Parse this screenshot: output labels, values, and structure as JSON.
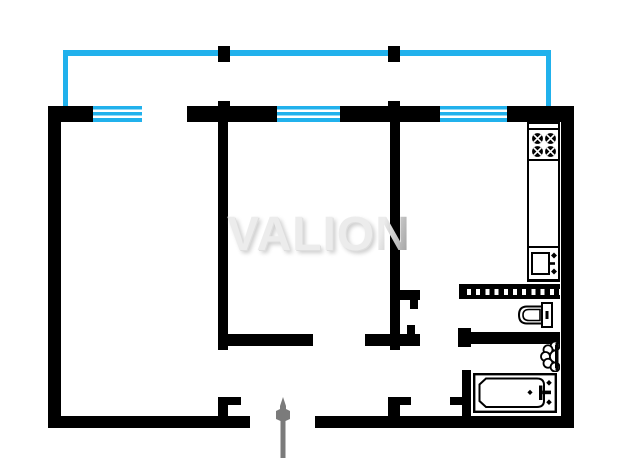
{
  "watermark": {
    "main": "VALIO",
    "last": "N",
    "full_text": "VALION"
  },
  "colors": {
    "wall": "#000000",
    "balcony": "#21b1ec",
    "window_cyan": "#21b1ec",
    "arrow_gray": "#7b7b7b",
    "background": "#ffffff",
    "watermark_light": "#ececec",
    "watermark_dark": "#a0a0a0"
  },
  "plan": {
    "canvas": {
      "width": 630,
      "height": 475
    },
    "door_openings": [
      "balcony-door-opening",
      "bedroom-door-opening",
      "livingroom-door-opening",
      "kitchen-door-opening",
      "wc-door-opening",
      "bathroom-door-opening",
      "entrance-door-opening"
    ],
    "elements": [
      {
        "name": "balcony-rail-top",
        "cls": "balcony",
        "x": 63,
        "y": 50,
        "w": 488,
        "h": 6
      },
      {
        "name": "balcony-rail-left",
        "cls": "balcony",
        "x": 63,
        "y": 50,
        "w": 5,
        "h": 57
      },
      {
        "name": "balcony-rail-right",
        "cls": "balcony",
        "x": 546,
        "y": 50,
        "w": 5,
        "h": 57
      },
      {
        "name": "balcony-divider-left",
        "cls": "wall",
        "x": 218,
        "y": 46,
        "w": 12,
        "h": 16
      },
      {
        "name": "balcony-divider-right",
        "cls": "wall",
        "x": 388,
        "y": 46,
        "w": 12,
        "h": 16
      },
      {
        "name": "top-wall-a",
        "cls": "wall",
        "x": 48,
        "y": 106,
        "w": 45,
        "h": 16
      },
      {
        "name": "top-wall-b",
        "cls": "wall",
        "x": 187,
        "y": 106,
        "w": 90,
        "h": 16
      },
      {
        "name": "top-wall-c",
        "cls": "wall",
        "x": 340,
        "y": 106,
        "w": 100,
        "h": 16
      },
      {
        "name": "top-wall-d",
        "cls": "wall",
        "x": 507,
        "y": 106,
        "w": 67,
        "h": 16
      },
      {
        "name": "top-wall-bump-left",
        "cls": "wall",
        "x": 218,
        "y": 101,
        "w": 12,
        "h": 6
      },
      {
        "name": "top-wall-bump-right",
        "cls": "wall",
        "x": 388,
        "y": 101,
        "w": 12,
        "h": 6
      },
      {
        "name": "window-livingroom",
        "cls": "window",
        "x": 93,
        "y": 106,
        "w": 49,
        "h": 16
      },
      {
        "name": "window-bedroom",
        "cls": "window",
        "x": 277,
        "y": 106,
        "w": 63,
        "h": 16
      },
      {
        "name": "window-kitchen",
        "cls": "window",
        "x": 440,
        "y": 106,
        "w": 67,
        "h": 16
      },
      {
        "name": "left-wall",
        "cls": "wall",
        "x": 48,
        "y": 106,
        "w": 13,
        "h": 322
      },
      {
        "name": "right-wall",
        "cls": "wall",
        "x": 561,
        "y": 106,
        "w": 13,
        "h": 322
      },
      {
        "name": "bottom-wall-left",
        "cls": "wall",
        "x": 48,
        "y": 416,
        "w": 202,
        "h": 12
      },
      {
        "name": "bottom-wall-right",
        "cls": "wall",
        "x": 315,
        "y": 416,
        "w": 259,
        "h": 12
      },
      {
        "name": "livingroom-bedroom-wall",
        "cls": "wall",
        "x": 218,
        "y": 122,
        "w": 10,
        "h": 228
      },
      {
        "name": "bedroom-kitchen-wall",
        "cls": "wall",
        "x": 390,
        "y": 122,
        "w": 10,
        "h": 228
      },
      {
        "name": "hallway-top-wall-left",
        "cls": "wall",
        "x": 218,
        "y": 334,
        "w": 95,
        "h": 12
      },
      {
        "name": "hallway-top-wall-right",
        "cls": "wall",
        "x": 365,
        "y": 334,
        "w": 25,
        "h": 12
      },
      {
        "name": "kitchen-door-jamb-a",
        "cls": "wall",
        "x": 400,
        "y": 290,
        "w": 20,
        "h": 10
      },
      {
        "name": "kitchen-door-jamb-b",
        "cls": "wall",
        "x": 410,
        "y": 300,
        "w": 8,
        "h": 9
      },
      {
        "name": "kitchen-door-jamb-c",
        "cls": "wall",
        "x": 407,
        "y": 325,
        "w": 8,
        "h": 9
      },
      {
        "name": "kitchen-door-jamb-d",
        "cls": "wall",
        "x": 400,
        "y": 334,
        "w": 20,
        "h": 12
      },
      {
        "name": "livingroom-door-stub",
        "cls": "wall",
        "x": 218,
        "y": 397,
        "w": 10,
        "h": 19
      },
      {
        "name": "livingroom-door-jamb",
        "cls": "wall",
        "x": 228,
        "y": 397,
        "w": 13,
        "h": 8
      },
      {
        "name": "hallway-door-stub",
        "cls": "wall",
        "x": 388,
        "y": 397,
        "w": 12,
        "h": 19
      },
      {
        "name": "hallway-door-jamb",
        "cls": "wall",
        "x": 400,
        "y": 397,
        "w": 11,
        "h": 8
      },
      {
        "name": "bathroom-door-jamb",
        "cls": "wall",
        "x": 450,
        "y": 397,
        "w": 13,
        "h": 8
      },
      {
        "name": "bathroom-left-wall",
        "cls": "wall",
        "x": 462,
        "y": 370,
        "w": 9,
        "h": 46
      },
      {
        "name": "wc-bottom-wall-cap",
        "cls": "wall",
        "x": 458,
        "y": 328,
        "w": 13,
        "h": 19
      },
      {
        "name": "wc-bottom-wall",
        "cls": "wall",
        "x": 458,
        "y": 332,
        "w": 102,
        "h": 12
      },
      {
        "name": "vent-block-wall",
        "cls": "hatched",
        "x": 459,
        "y": 284,
        "w": 101,
        "h": 15
      }
    ]
  },
  "icons": [
    {
      "name": "stove-icon",
      "meaning": "4-burner kitchen stove"
    },
    {
      "name": "kitchen-sink-icon",
      "meaning": "kitchen sink with tap"
    },
    {
      "name": "toilet-icon",
      "meaning": "toilet with tank"
    },
    {
      "name": "washbasin-icon",
      "meaning": "bathroom washbasin"
    },
    {
      "name": "bathtub-icon",
      "meaning": "bathtub with tap"
    },
    {
      "name": "entrance-arrow-icon",
      "meaning": "apartment entrance direction arrow"
    }
  ]
}
